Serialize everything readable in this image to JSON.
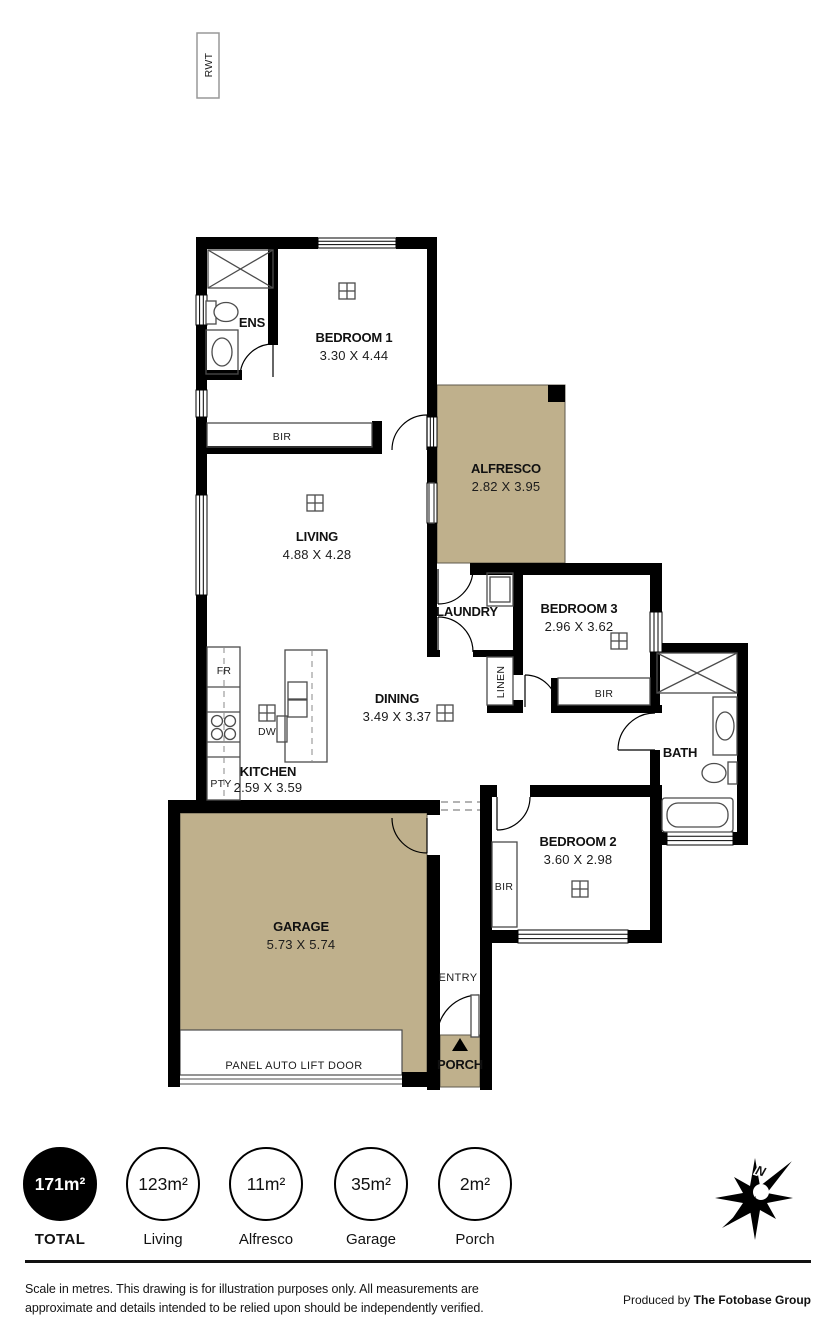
{
  "rwt": {
    "label": "RWT"
  },
  "colors": {
    "outdoor_fill": "#bfb08c",
    "wall": "#000000"
  },
  "rooms": {
    "ens": {
      "name": "ENS"
    },
    "bedroom1": {
      "name": "BEDROOM 1",
      "dims": "3.30 X 4.44"
    },
    "alfresco": {
      "name": "ALFRESCO",
      "dims": "2.82 X 3.95"
    },
    "living": {
      "name": "LIVING",
      "dims": "4.88 X 4.28"
    },
    "laundry": {
      "name": "LAUNDRY"
    },
    "bedroom3": {
      "name": "BEDROOM 3",
      "dims": "2.96 X 3.62"
    },
    "dining": {
      "name": "DINING",
      "dims": "3.49 X 3.37"
    },
    "kitchen": {
      "name": "KITCHEN",
      "dims": "2.59 X 3.59"
    },
    "bath": {
      "name": "BATH"
    },
    "bedroom2": {
      "name": "BEDROOM 2",
      "dims": "3.60 X 2.98"
    },
    "garage": {
      "name": "GARAGE",
      "dims": "5.73 X 5.74"
    },
    "entry": {
      "name": "ENTRY"
    },
    "porch": {
      "name": "PORCH"
    }
  },
  "storage": {
    "bir1": "BIR",
    "bir2": "BIR",
    "bir3": "BIR",
    "linen": "LINEN"
  },
  "appliances": {
    "fr": "FR",
    "dw": "DW",
    "pty": "PTY"
  },
  "garage_door": {
    "label": "PANEL AUTO LIFT DOOR"
  },
  "areas": {
    "total": {
      "value": "171m²",
      "label": "TOTAL"
    },
    "items": [
      {
        "value": "123m²",
        "label": "Living"
      },
      {
        "value": "11m²",
        "label": "Alfresco"
      },
      {
        "value": "35m²",
        "label": "Garage"
      },
      {
        "value": "2m²",
        "label": "Porch"
      }
    ]
  },
  "footer": {
    "disclaimer_line1": "Scale in metres. This drawing is for illustration purposes only. All measurements are",
    "disclaimer_line2": "approximate and details intended to be relied upon should be independently verified.",
    "produced_by_prefix": "Produced by ",
    "produced_by_company": "The Fotobase Group"
  }
}
